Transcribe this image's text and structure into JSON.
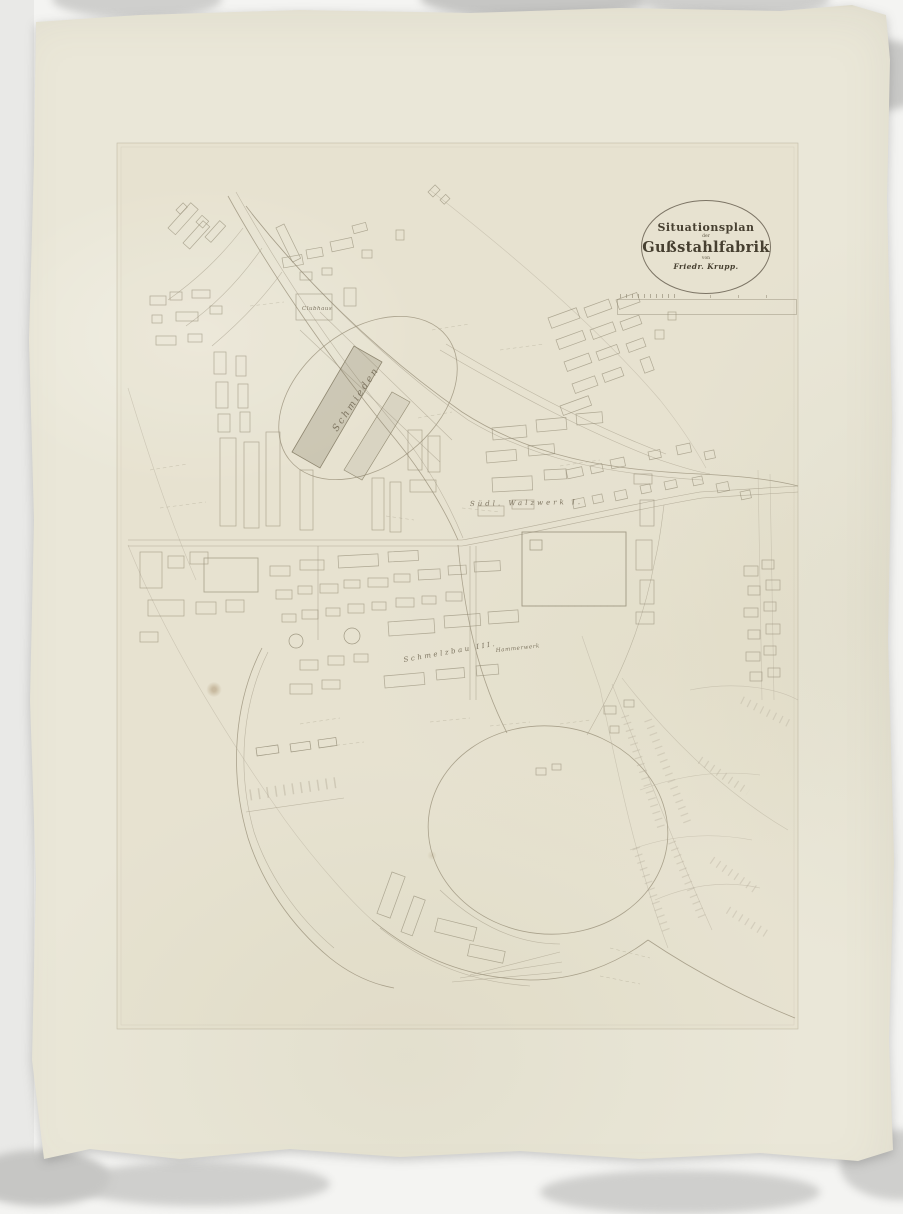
{
  "artifact": {
    "kind": "photograph of a 19th-century factory site plan",
    "colors": {
      "background": "#f4f4f2",
      "mount_strip": "#e9e9e7",
      "paper": "#eae7d8",
      "map_tint": "#e8e4d1",
      "ink_line": "#958c76",
      "pencil_line": "#b2aa97",
      "title_ink": "#463f30"
    }
  },
  "cartouche": {
    "line1": "Situationsplan",
    "line2": "der",
    "line3": "Gußstahlfabrik",
    "line4": "von",
    "line5": "Friedr. Krupp."
  },
  "map": {
    "labels": [
      {
        "id": "schmieden",
        "text": "Schmieden"
      },
      {
        "id": "clubhaus",
        "text": "Clubhaus"
      },
      {
        "id": "suedl-walzwerk",
        "text": "Südl. Walzwerk I."
      },
      {
        "id": "schmelzbau",
        "text": "Schmelzbau III."
      },
      {
        "id": "hammerwerk",
        "text": "Hammerwerk"
      }
    ]
  }
}
